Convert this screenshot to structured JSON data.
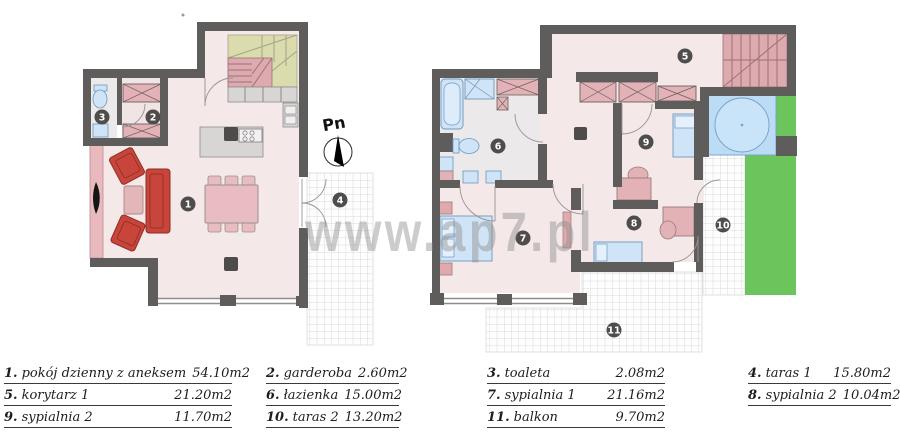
{
  "watermark": "www.ap7.pl",
  "compass": {
    "label": "Pn"
  },
  "rooms": [
    {
      "number": "1",
      "label": "1.",
      "name": "pokój dzienny z aneksem",
      "area": "54.10m2"
    },
    {
      "number": "2",
      "label": "2.",
      "name": "garderoba",
      "area": "2.60m2"
    },
    {
      "number": "3",
      "label": "3.",
      "name": "toaleta",
      "area": "2.08m2"
    },
    {
      "number": "4",
      "label": "4.",
      "name": "taras 1",
      "area": "15.80m2"
    },
    {
      "number": "5",
      "label": "5.",
      "name": "korytarz 1",
      "area": "21.20m2"
    },
    {
      "number": "6",
      "label": "6.",
      "name": "łazienka",
      "area": "15.00m2"
    },
    {
      "number": "7",
      "label": "7.",
      "name": "sypialnia 1",
      "area": "21.16m2"
    },
    {
      "number": "8",
      "label": "8.",
      "name": "sypialnia 2",
      "area": "10.04m2"
    },
    {
      "number": "9",
      "label": "9.",
      "name": "sypialnia 2",
      "area": "11.70m2"
    },
    {
      "number": "10",
      "label": "10.",
      "name": "taras 2",
      "area": "13.20m2"
    },
    {
      "number": "11",
      "label": "11.",
      "name": "balkon",
      "area": "9.70m2"
    }
  ]
}
